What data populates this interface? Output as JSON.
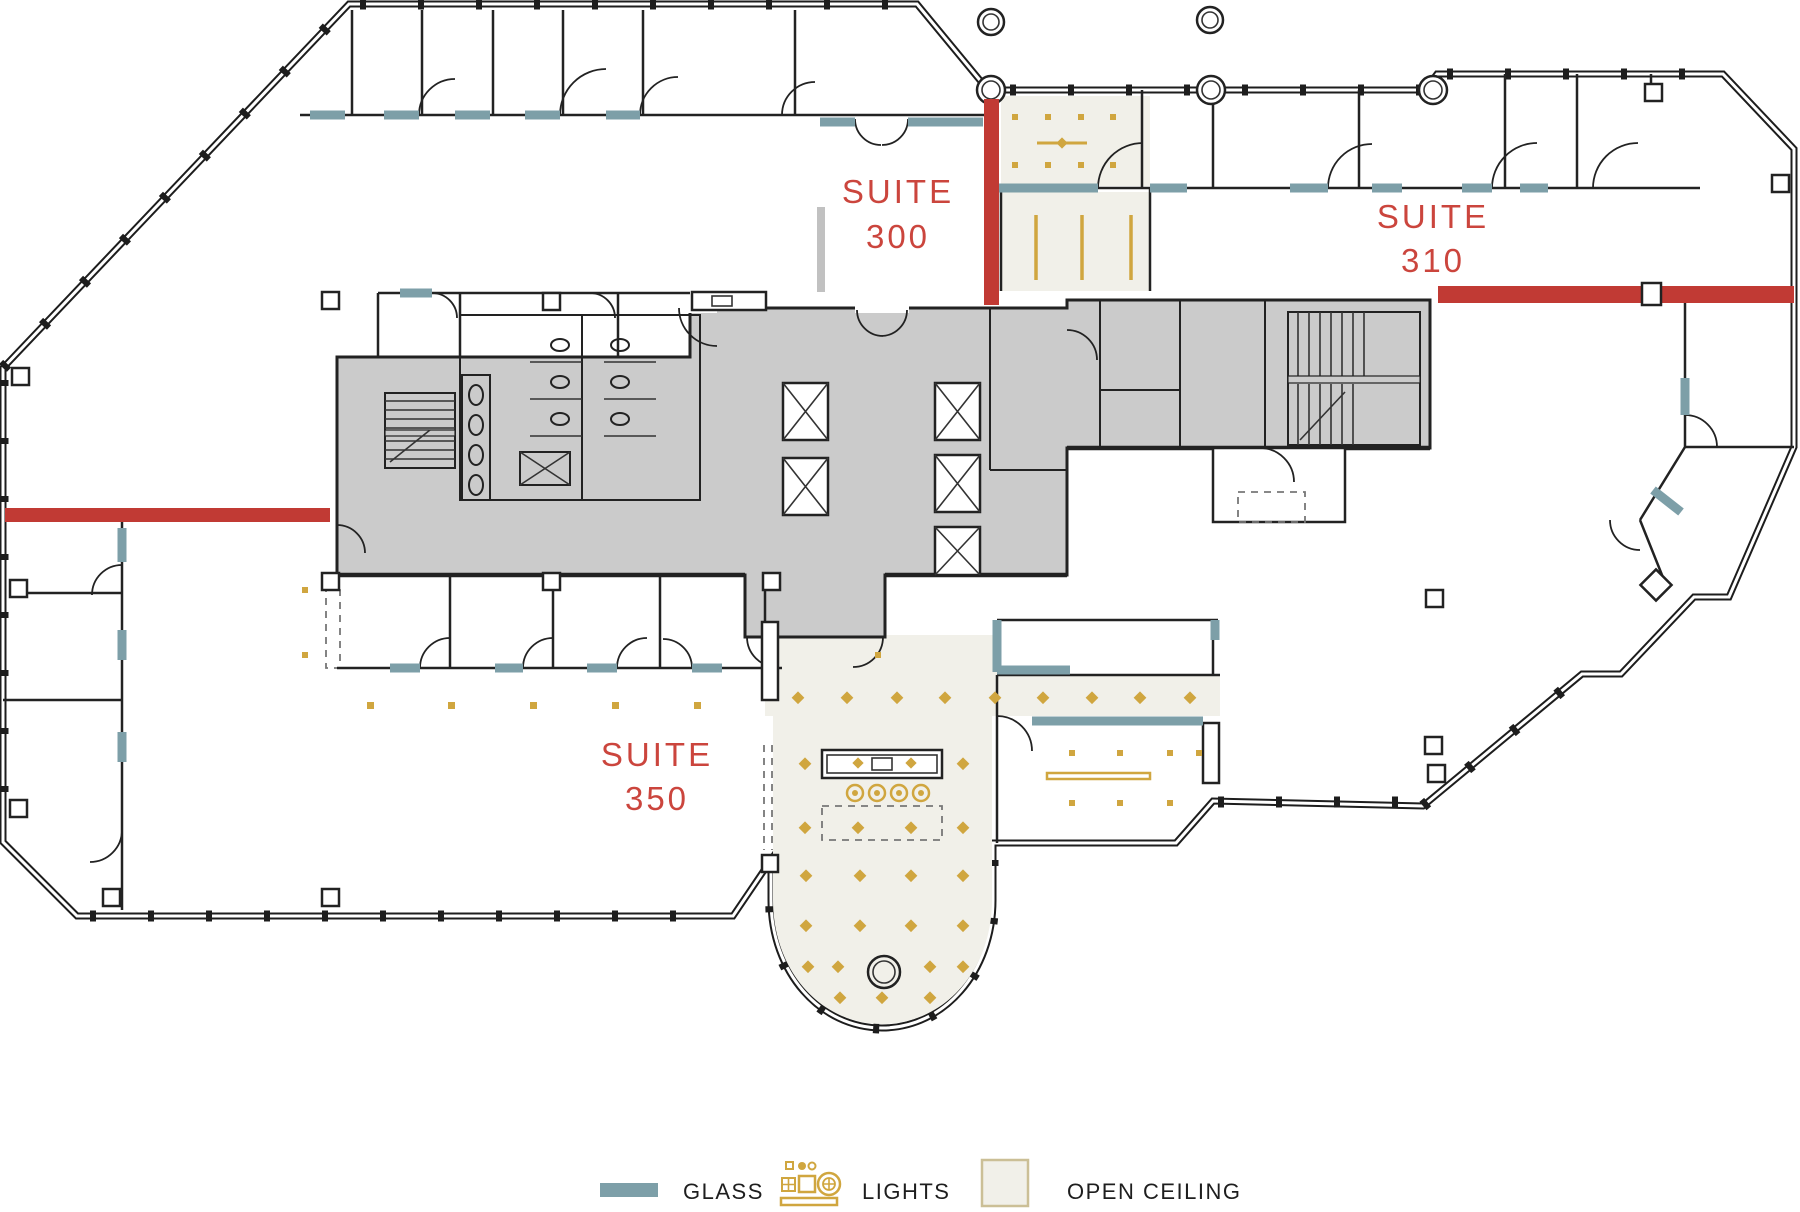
{
  "plan": {
    "title": "Floor plan - 3rd floor suites",
    "suites": [
      {
        "id": "300",
        "line1": "SUITE",
        "line2": "300"
      },
      {
        "id": "310",
        "line1": "SUITE",
        "line2": "310"
      },
      {
        "id": "350",
        "line1": "SUITE",
        "line2": "350"
      }
    ]
  },
  "legend": {
    "glass_label": "GLASS",
    "lights_label": "LIGHTS",
    "open_ceiling_label": "OPEN CEILING"
  },
  "colors": {
    "demising_red": "#c13a34",
    "label_red": "#cb453d",
    "glass_teal": "#7d9fa8",
    "light_gold": "#d0a63f",
    "open_ceiling_fill": "#f1f0e9",
    "open_ceiling_border": "#cbbf96",
    "core_gray": "#cbcbcb",
    "wall_dark": "#1d1d1d"
  }
}
